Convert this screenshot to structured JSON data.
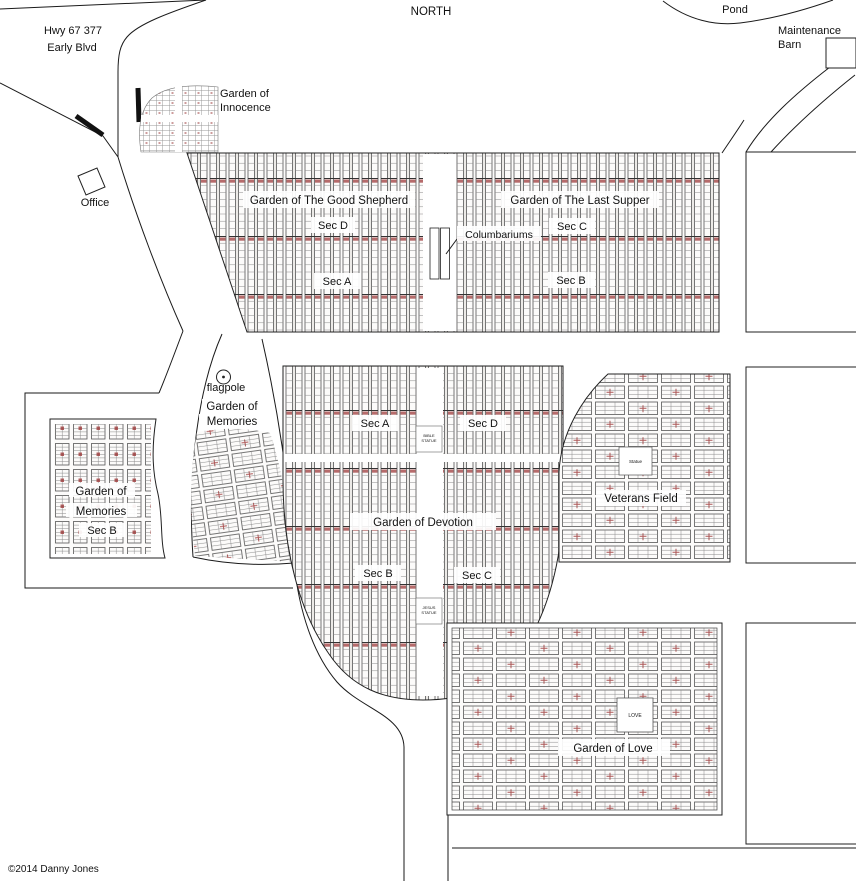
{
  "compass": {
    "north": "NORTH"
  },
  "copyright": "©2014 Danny Jones",
  "landmarks": {
    "highway": {
      "line1": "Hwy 67 377",
      "line2": "Early Blvd"
    },
    "pond": "Pond",
    "maintenance_barn": {
      "line1": "Maintenance",
      "line2": "Barn"
    },
    "office": "Office",
    "flagpole": "flagpole",
    "columbariums": "Columbariums"
  },
  "monuments": {
    "bible_statue": {
      "line1": "BIBLE",
      "line2": "STATUE"
    },
    "jesus_statue": {
      "line1": "JESUS",
      "line2": "STATUE"
    },
    "veterans_statue": "Statue",
    "love_marker": "LOVE"
  },
  "sections": {
    "innocence": {
      "name": "Garden of Innocence",
      "line1": "Garden of",
      "line2": "Innocence"
    },
    "good_shepherd": {
      "name": "Garden of The Good Shepherd",
      "sec_d": "Sec D",
      "sec_a": "Sec A"
    },
    "last_supper": {
      "name": "Garden of The Last Supper",
      "sec_c": "Sec C",
      "sec_b": "Sec B"
    },
    "memories": {
      "name": "Garden of Memories",
      "line1": "Garden of",
      "line2": "Memories"
    },
    "memories_sec_b": {
      "name": "Garden of Memories Sec B",
      "line1": "Garden of",
      "line2": "Memories",
      "line3": "Sec B"
    },
    "devotion": {
      "name": "Garden of Devotion",
      "sec_a": "Sec A",
      "sec_d": "Sec D",
      "sec_b": "Sec B",
      "sec_c": "Sec C"
    },
    "veterans": {
      "name": "Veterans Field"
    },
    "love": {
      "name": "Garden of Love"
    }
  },
  "colors": {
    "plot_line": "#4a4a4a",
    "plot_marker_red": "#9e3a3a",
    "road_line": "#1a1a1a",
    "background": "#ffffff"
  }
}
